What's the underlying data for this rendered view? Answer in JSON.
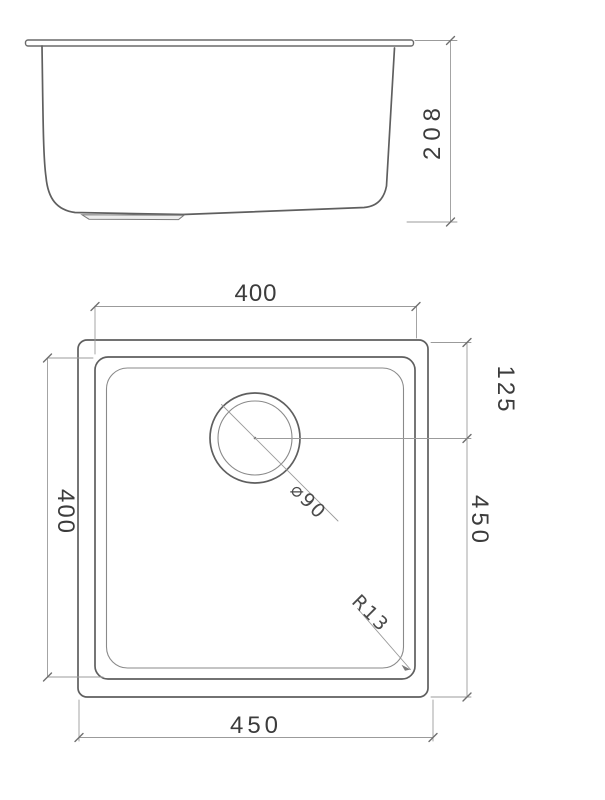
{
  "drawing": {
    "title": "undermount-sink-technical-drawing",
    "background_color": "#ffffff",
    "outline_color": "#5f5f5f",
    "dimension_line_color": "#9b9b9b",
    "text_color": "#3c3c3c"
  },
  "side_view": {
    "height_label": "208"
  },
  "plan_view": {
    "bowl_width_label": "400",
    "bowl_depth_label": "400",
    "drain_offset_label": "125",
    "outer_depth_label": "450",
    "outer_width_label": "450",
    "drain_diameter_label": "⌀90",
    "corner_radius_label": "R13"
  }
}
